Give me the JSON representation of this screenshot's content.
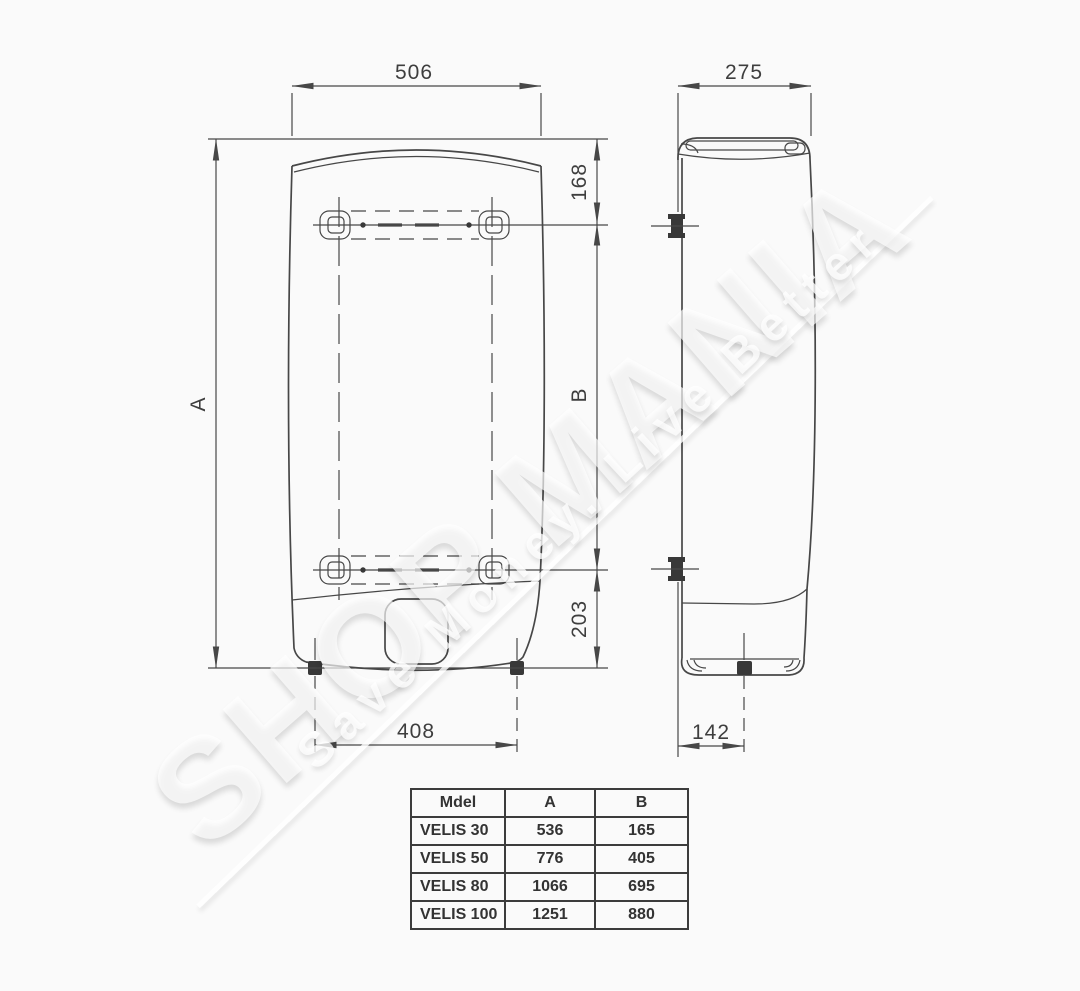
{
  "watermark": {
    "brand": "SHOP MANIA",
    "tagline": "Save Money. Live Better"
  },
  "front_view": {
    "dims": {
      "top_width": "506",
      "height": "A",
      "top_to_bracket": "168",
      "bracket_spacing": "B",
      "bracket_to_bottom": "203",
      "pipe_spacing": "408"
    }
  },
  "side_view": {
    "dims": {
      "depth": "275",
      "pipe_to_back": "142"
    }
  },
  "spec_table": {
    "headers": [
      "Mdel",
      "A",
      "B"
    ],
    "rows": [
      {
        "model": "VELIS 30",
        "a": "536",
        "b": "165"
      },
      {
        "model": "VELIS 50",
        "a": "776",
        "b": "405"
      },
      {
        "model": "VELIS 80",
        "a": "1066",
        "b": "695"
      },
      {
        "model": "VELIS 100",
        "a": "1251",
        "b": "880"
      }
    ]
  }
}
